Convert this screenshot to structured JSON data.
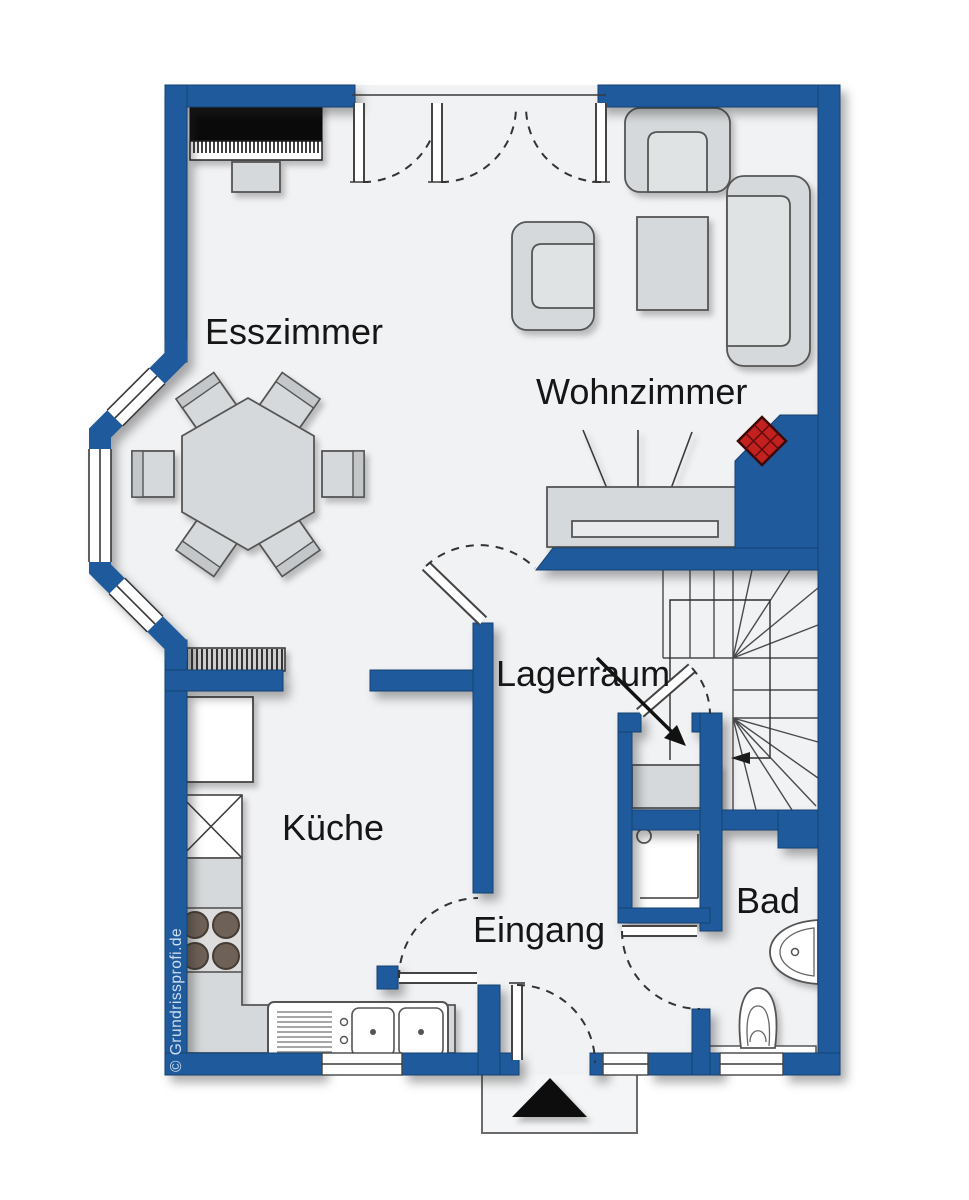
{
  "page": {
    "type": "floor-plan",
    "title": "Grundriss Erdgeschoss"
  },
  "watermark": "© Grundrissprofi.de",
  "rooms": {
    "esszimmer": {
      "label": "Esszimmer"
    },
    "wohnzimmer": {
      "label": "Wohnzimmer"
    },
    "lagerraum": {
      "label": "Lagerraum"
    },
    "kueche": {
      "label": "Küche"
    },
    "eingang": {
      "label": "Eingang"
    },
    "bad": {
      "label": "Bad"
    }
  },
  "colors": {
    "wall_blue": "#1f5b9c",
    "floor": "#f1f2f4",
    "furniture_gray": "#d6d9db",
    "furniture_dark": "#c3c7c9",
    "stove_red": "#c32020",
    "stove_red_dark": "#5f0d0d"
  },
  "symbols": [
    "grand-piano",
    "dining-table",
    "dining-chair",
    "armchair",
    "sofa",
    "coffee-table",
    "tv-sideboard",
    "wood-stove",
    "radiator",
    "fridge",
    "appliance-crossed",
    "cooktop",
    "kitchen-counter",
    "kitchen-sink",
    "storage-shelf",
    "shower",
    "washbasin",
    "toilet",
    "winder-stairs",
    "entrance-arrow",
    "door-swing",
    "window",
    "bay-window"
  ]
}
